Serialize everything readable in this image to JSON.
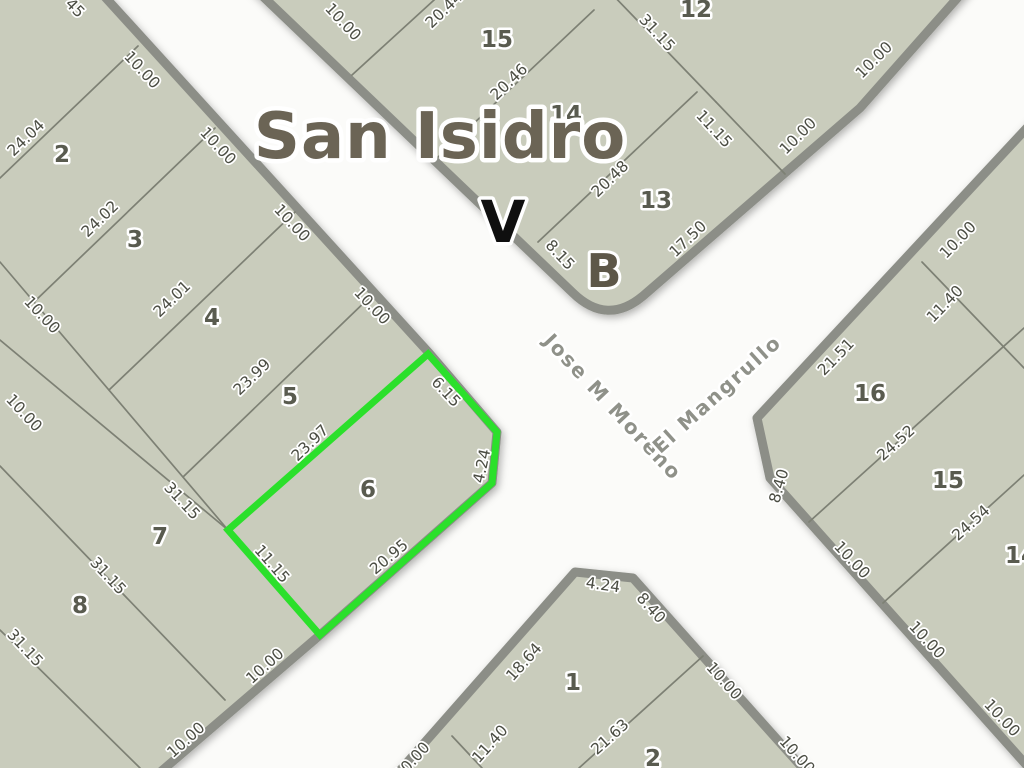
{
  "map": {
    "title": "San Isidro",
    "corner_marker": "V",
    "block_letter": "B",
    "highlighted_parcel": "6",
    "street_names": [
      {
        "text": "Jose M Moreno",
        "x": 613,
        "y": 407,
        "rot": 47
      },
      {
        "text": "El Mangrullo",
        "x": 717,
        "y": 394,
        "rot": -42
      }
    ],
    "colors": {
      "street": "#fbfbf9",
      "block_fill": "#c9ccbc",
      "edge": "#8c8e87",
      "parcel_line": "#7d8074",
      "highlight": "#2be02b",
      "dim_text": "#4b4d43",
      "number_text": "#595b4f",
      "title_text": "#6b6455",
      "street_text": "#8f9189",
      "marker_v_color": "#0f0f0f",
      "letter_b_color": "#5d5748"
    },
    "dimensions": [
      {
        "t": "45",
        "x": 75,
        "y": 8,
        "r": 46
      },
      {
        "t": "24.04",
        "x": 26,
        "y": 138,
        "r": -44
      },
      {
        "t": "24.02",
        "x": 100,
        "y": 219,
        "r": -44
      },
      {
        "t": "24.01",
        "x": 172,
        "y": 299,
        "r": -44
      },
      {
        "t": "23.99",
        "x": 252,
        "y": 377,
        "r": -44
      },
      {
        "t": "23.97",
        "x": 310,
        "y": 443,
        "r": -44
      },
      {
        "t": "10.00",
        "x": 142,
        "y": 70,
        "r": 47
      },
      {
        "t": "10.00",
        "x": 218,
        "y": 146,
        "r": 47
      },
      {
        "t": "10.00",
        "x": 292,
        "y": 223,
        "r": 47
      },
      {
        "t": "10.00",
        "x": 372,
        "y": 306,
        "r": 47
      },
      {
        "t": "10.00",
        "x": 42,
        "y": 315,
        "r": 47
      },
      {
        "t": "10.00",
        "x": 24,
        "y": 413,
        "r": 47
      },
      {
        "t": "31.15",
        "x": 182,
        "y": 501,
        "r": 47
      },
      {
        "t": "31.15",
        "x": 108,
        "y": 576,
        "r": 47
      },
      {
        "t": "31.15",
        "x": 25,
        "y": 648,
        "r": 47
      },
      {
        "t": "10.00",
        "x": 265,
        "y": 666,
        "r": -42
      },
      {
        "t": "10.00",
        "x": 186,
        "y": 740,
        "r": -42
      },
      {
        "t": "6.15",
        "x": 446,
        "y": 392,
        "r": 47
      },
      {
        "t": "4.24",
        "x": 482,
        "y": 466,
        "r": -78
      },
      {
        "t": "20.95",
        "x": 389,
        "y": 557,
        "r": -40
      },
      {
        "t": "11.15",
        "x": 272,
        "y": 564,
        "r": 49
      },
      {
        "t": "10.00",
        "x": 343,
        "y": 22,
        "r": 47
      },
      {
        "t": "20.44",
        "x": 444,
        "y": 10,
        "r": -44
      },
      {
        "t": "20.46",
        "x": 509,
        "y": 82,
        "r": -44
      },
      {
        "t": "20.48",
        "x": 610,
        "y": 179,
        "r": -44
      },
      {
        "t": "31.15",
        "x": 657,
        "y": 33,
        "r": 47
      },
      {
        "t": "11.15",
        "x": 714,
        "y": 129,
        "r": 47
      },
      {
        "t": "17.50",
        "x": 688,
        "y": 239,
        "r": -44
      },
      {
        "t": "8.15",
        "x": 560,
        "y": 255,
        "r": 47
      },
      {
        "t": "10.00",
        "x": 874,
        "y": 60,
        "r": -45
      },
      {
        "t": "10.00",
        "x": 798,
        "y": 136,
        "r": -45
      },
      {
        "t": "10.00",
        "x": 958,
        "y": 240,
        "r": -46
      },
      {
        "t": "11.40",
        "x": 945,
        "y": 304,
        "r": -46
      },
      {
        "t": "21.51",
        "x": 836,
        "y": 357,
        "r": -46
      },
      {
        "t": "8.40",
        "x": 779,
        "y": 486,
        "r": -74
      },
      {
        "t": "24.52",
        "x": 896,
        "y": 443,
        "r": -42
      },
      {
        "t": "24.54",
        "x": 971,
        "y": 523,
        "r": -42
      },
      {
        "t": "10.00",
        "x": 852,
        "y": 560,
        "r": 47
      },
      {
        "t": "10.00",
        "x": 927,
        "y": 640,
        "r": 47
      },
      {
        "t": "10.00",
        "x": 1002,
        "y": 718,
        "r": 47
      },
      {
        "t": "4.24",
        "x": 603,
        "y": 585,
        "r": 8
      },
      {
        "t": "8.40",
        "x": 651,
        "y": 608,
        "r": 48
      },
      {
        "t": "18.64",
        "x": 524,
        "y": 662,
        "r": -48
      },
      {
        "t": "11.40",
        "x": 490,
        "y": 744,
        "r": -48
      },
      {
        "t": "21.63",
        "x": 610,
        "y": 737,
        "r": -42
      },
      {
        "t": "10.00",
        "x": 724,
        "y": 681,
        "r": 48
      },
      {
        "t": "10.00",
        "x": 797,
        "y": 755,
        "r": 48
      },
      {
        "t": "10.00",
        "x": 412,
        "y": 761,
        "r": -48
      }
    ],
    "parcel_numbers": [
      {
        "t": "2",
        "x": 62,
        "y": 155
      },
      {
        "t": "3",
        "x": 135,
        "y": 240
      },
      {
        "t": "4",
        "x": 212,
        "y": 318
      },
      {
        "t": "5",
        "x": 290,
        "y": 397
      },
      {
        "t": "6",
        "x": 368,
        "y": 490
      },
      {
        "t": "7",
        "x": 160,
        "y": 537
      },
      {
        "t": "8",
        "x": 80,
        "y": 606
      },
      {
        "t": "15",
        "x": 497,
        "y": 40
      },
      {
        "t": "14",
        "x": 566,
        "y": 115
      },
      {
        "t": "13",
        "x": 656,
        "y": 201
      },
      {
        "t": "12",
        "x": 696,
        "y": 10
      },
      {
        "t": "16",
        "x": 870,
        "y": 394
      },
      {
        "t": "15",
        "x": 948,
        "y": 481
      },
      {
        "t": "14",
        "x": 1021,
        "y": 556
      },
      {
        "t": "1",
        "x": 573,
        "y": 683
      },
      {
        "t": "2",
        "x": 653,
        "y": 759
      }
    ]
  }
}
